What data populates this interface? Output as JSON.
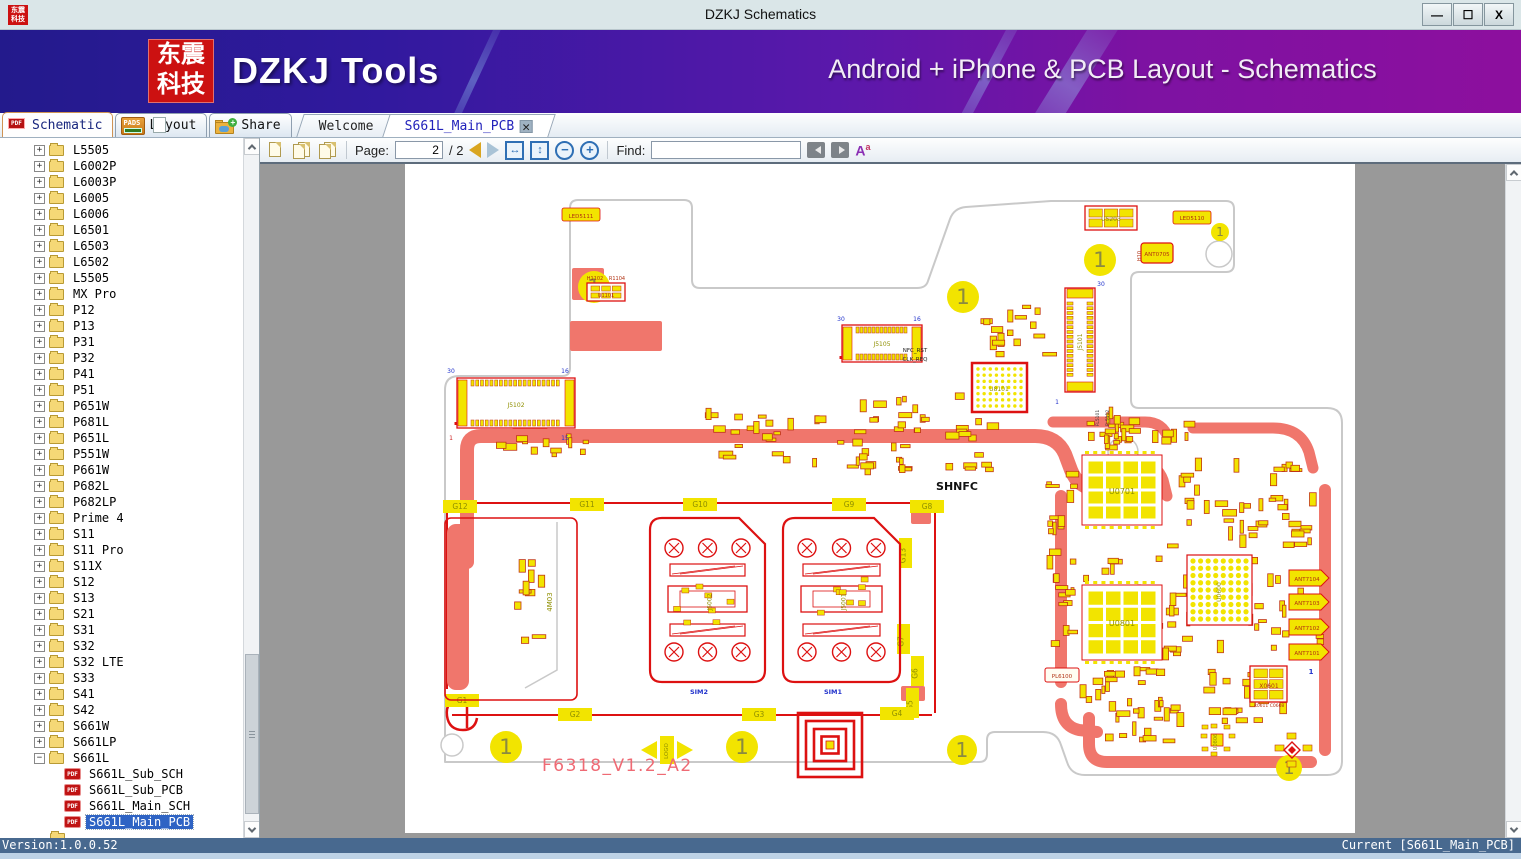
{
  "window": {
    "title": "DZKJ Schematics",
    "logo_text": "东震科技",
    "controls": [
      {
        "name": "minimize",
        "glyph": "—"
      },
      {
        "name": "maximize",
        "glyph": "☐"
      },
      {
        "name": "close",
        "glyph": "X"
      }
    ]
  },
  "banner": {
    "logo_line1": "东震",
    "logo_line2": "科技",
    "app_name": "DZKJ Tools",
    "tagline": "Android + iPhone & PCB Layout - Schematics"
  },
  "tabs": {
    "tool_tabs": [
      {
        "label": "Schematic",
        "icon": "pdf",
        "active": true
      },
      {
        "label": "Layout",
        "icon": "pads",
        "active": false
      },
      {
        "label": "Share",
        "icon": "share",
        "active": false
      }
    ],
    "doc_tabs": [
      {
        "label": "Welcome",
        "closable": false,
        "active": false
      },
      {
        "label": "S661L_Main_PCB",
        "closable": true,
        "active": true
      }
    ]
  },
  "toolbar": {
    "page_label": "Page:",
    "page_value": "2",
    "page_total": "/ 2",
    "find_label": "Find:",
    "find_value": ""
  },
  "sidebar": {
    "folders": [
      "L5505",
      "L6002P",
      "L6003P",
      "L6005",
      "L6006",
      "L6501",
      "L6503",
      "L6502",
      "L5505",
      "MX Pro",
      "P12",
      "P13",
      "P31",
      "P32",
      "P41",
      "P51",
      "P651W",
      "P681L",
      "P651L",
      "P551W",
      "P661W",
      "P682L",
      "P682LP",
      "Prime 4",
      "S11",
      "S11 Pro",
      "S11X",
      "S12",
      "S13",
      "S21",
      "S31",
      "S32",
      "S32 LTE",
      "S33",
      "S41",
      "S42",
      "S661W",
      "S661LP"
    ],
    "expanded_folder": "S661L",
    "documents": [
      {
        "label": "S661L_Sub_SCH",
        "selected": false
      },
      {
        "label": "S661L_Sub_PCB",
        "selected": false
      },
      {
        "label": "S661L_Main_SCH",
        "selected": false
      },
      {
        "label": "S661L_Main_PCB",
        "selected": true
      }
    ]
  },
  "statusbar": {
    "left": "Version:1.0.0.52",
    "right": "Current [S661L_Main_PCB]"
  },
  "pcb": {
    "colors": {
      "outline": "#c9c9c9",
      "copper": "#f0766c",
      "red": "#dd1111",
      "yellow": "#f2e400",
      "olive": "#8f8f00",
      "darkred": "#b03010",
      "blue": "#2233cc",
      "pink": "#ef6a74"
    },
    "outline_path": "M 40,598 V 226 Q 40,212 54,212 H 157 Q 165,212 165,204 V 44 Q 165,36 173,36 H 279 Q 287,36 287,44 V 116 Q 287,124 295,124 H 512 Q 521,124 523,117 L 545,55 Q 549,44 561,43 L 646,37 H 821 Q 829,37 829,45 V 100 Q 829,108 821,108 H 734 Q 726,108 726,116 V 236 Q 726,244 734,244 H 922 Q 937,244 937,259 V 597 Q 937,611 922,611 H 680 Q 666,611 662,598 L 656,581 Q 652,568 638,568 H 590 Q 582,568 582,576 V 590 Q 582,598 574,598 Z",
    "copper_strokes": [
      {
        "d": "M 62,398 V 286 Q 62,272 76,272 H 630 Q 652,272 660,290 L 666,306 Q 673,324 693,326 L 714,328",
        "w": 14
      },
      {
        "d": "M 734,298 Q 752,300 758,316 L 762,332",
        "w": 11
      },
      {
        "d": "M 648,258 H 740 Q 758,258 763,274",
        "w": 11
      },
      {
        "d": "M 788,264 H 868 Q 896,264 904,288 L 908,304",
        "w": 11
      },
      {
        "d": "M 920,326 V 586",
        "w": 12
      },
      {
        "d": "M 906,598 H 702 Q 684,598 684,580 V 554",
        "w": 12
      },
      {
        "d": "M 656,332 V 518",
        "w": 12
      },
      {
        "d": "M 656,540 Q 656,562 674,566 L 692,568",
        "w": 12
      }
    ],
    "copper_fills": [
      {
        "x": 165,
        "y": 157,
        "w": 92,
        "h": 30,
        "r": 2
      },
      {
        "x": 167,
        "y": 104,
        "w": 32,
        "h": 32,
        "r": 2
      },
      {
        "x": 107,
        "y": 262,
        "w": 36,
        "h": 10,
        "r": 5
      },
      {
        "x": 506,
        "y": 346,
        "w": 20,
        "h": 14,
        "r": 2
      },
      {
        "x": 496,
        "y": 522,
        "w": 24,
        "h": 15,
        "r": 2
      }
    ],
    "red_lines": [
      {
        "d": "M 42,339 H 530",
        "w": 2
      },
      {
        "d": "M 47,551 H 527",
        "w": 2
      },
      {
        "d": "M 530,341 V 549",
        "w": 2
      },
      {
        "d": "M 42,341 V 525",
        "w": 2
      },
      {
        "d": "M 56,534 q -16,2 -14,18 q 2,14 16,14 q 12,0 14,-12 M 62,534 v 30",
        "w": 2.5
      }
    ],
    "fiducials": [
      {
        "x": 189,
        "y": 123,
        "r": 16
      },
      {
        "x": 558,
        "y": 133,
        "r": 16
      },
      {
        "x": 695,
        "y": 96,
        "r": 16
      },
      {
        "x": 815,
        "y": 68,
        "r": 9
      },
      {
        "x": 101,
        "y": 583,
        "r": 16
      },
      {
        "x": 337,
        "y": 583,
        "r": 16
      },
      {
        "x": 557,
        "y": 586,
        "r": 15
      },
      {
        "x": 884,
        "y": 604,
        "r": 13
      }
    ],
    "holes": [
      {
        "x": 814,
        "y": 90,
        "r": 13
      },
      {
        "x": 718,
        "y": 288,
        "r": 15
      },
      {
        "x": 47,
        "y": 581,
        "r": 11
      }
    ],
    "g_pads": [
      {
        "label": "G12",
        "x": 38,
        "y": 336,
        "v": false
      },
      {
        "label": "G11",
        "x": 165,
        "y": 334,
        "v": false
      },
      {
        "label": "G10",
        "x": 278,
        "y": 334,
        "v": false
      },
      {
        "label": "G9",
        "x": 427,
        "y": 334,
        "v": false
      },
      {
        "label": "G8",
        "x": 505,
        "y": 336,
        "v": false
      },
      {
        "label": "G13",
        "x": 494,
        "y": 374,
        "v": true
      },
      {
        "label": "G7",
        "x": 492,
        "y": 460,
        "v": true
      },
      {
        "label": "G6",
        "x": 506,
        "y": 492,
        "v": true
      },
      {
        "label": "G5",
        "x": 501,
        "y": 524,
        "v": true
      },
      {
        "label": "G4",
        "x": 475,
        "y": 543,
        "v": false
      },
      {
        "label": "G3",
        "x": 337,
        "y": 544,
        "v": false
      },
      {
        "label": "G2",
        "x": 153,
        "y": 544,
        "v": false
      },
      {
        "label": "G1",
        "x": 40,
        "y": 530,
        "v": false
      }
    ],
    "connectors": [
      {
        "ref": "J5102",
        "x": 52,
        "y": 214,
        "w": 118,
        "h": 50,
        "vert": false,
        "pins": 19
      },
      {
        "ref": "J5105",
        "x": 437,
        "y": 161,
        "w": 80,
        "h": 37,
        "vert": false,
        "pins": 13
      },
      {
        "ref": "J5101",
        "x": 660,
        "y": 124,
        "w": 30,
        "h": 104,
        "vert": true,
        "pins": 16
      }
    ],
    "ics": [
      {
        "ref": "U8101",
        "type": "dots",
        "x": 567,
        "y": 199,
        "w": 55,
        "h": 49,
        "nx": 8,
        "ny": 7,
        "r": 1.7,
        "stroke": 2.5
      },
      {
        "ref": "U0600",
        "type": "dots",
        "x": 782,
        "y": 391,
        "w": 65,
        "h": 70,
        "nx": 8,
        "ny": 9,
        "r": 2.6,
        "stroke": 1.2
      },
      {
        "ref": "U0701",
        "type": "squares",
        "x": 677,
        "y": 291,
        "w": 80,
        "h": 70
      },
      {
        "ref": "U0801",
        "type": "squares",
        "x": 677,
        "y": 421,
        "w": 80,
        "h": 75
      },
      {
        "ref": "U5203",
        "type": "pads6",
        "x": 680,
        "y": 42,
        "w": 52,
        "h": 24,
        "cols": 3,
        "rows": 2
      },
      {
        "ref": "U1101",
        "type": "pads6",
        "x": 182,
        "y": 119,
        "w": 38,
        "h": 18,
        "cols": 3,
        "rows": 2
      },
      {
        "ref": "X0601",
        "type": "pads6",
        "x": 845,
        "y": 502,
        "w": 37,
        "h": 36,
        "cols": 2,
        "rows": 3
      },
      {
        "ref": "U0806",
        "type": "padring",
        "x": 797,
        "y": 561,
        "w": 30,
        "h": 30
      },
      {
        "ref": "X0802",
        "type": "diamond",
        "x": 872,
        "y": 571,
        "w": 30,
        "h": 30
      }
    ],
    "sim_slots": [
      {
        "x": 245,
        "y": 354,
        "w": 115,
        "h": 164,
        "label": "SIM2",
        "ref": "J5002"
      },
      {
        "x": 378,
        "y": 354,
        "w": 117,
        "h": 164,
        "label": "SIM1",
        "ref": "J5001"
      }
    ],
    "card_slot": {
      "x": 40,
      "y": 354,
      "w": 132,
      "h": 182,
      "ref": "4M03"
    },
    "ant_pads": [
      {
        "label": "ANT7104",
        "x": 884,
        "y": 406
      },
      {
        "label": "ANT7103",
        "x": 884,
        "y": 430
      },
      {
        "label": "ANT7102",
        "x": 884,
        "y": 455
      },
      {
        "label": "ANT7101",
        "x": 884,
        "y": 480
      }
    ],
    "spiral": {
      "cx": 425,
      "cy": 581,
      "sizes": [
        64,
        48,
        32,
        17
      ]
    },
    "logo_marker": {
      "x": 262,
      "y": 586,
      "label": "LOGO"
    },
    "clusters": [
      [
        405,
        228,
        125,
        85,
        34,
        1
      ],
      [
        298,
        238,
        92,
        62,
        18,
        2
      ],
      [
        88,
        268,
        115,
        26,
        12,
        3
      ],
      [
        540,
        222,
        58,
        88,
        16,
        4
      ],
      [
        575,
        140,
        80,
        58,
        16,
        5
      ],
      [
        688,
        236,
        50,
        52,
        12,
        6
      ],
      [
        640,
        296,
        34,
        195,
        22,
        7
      ],
      [
        762,
        292,
        158,
        92,
        44,
        8
      ],
      [
        762,
        392,
        158,
        100,
        44,
        9
      ],
      [
        660,
        388,
        115,
        108,
        34,
        10
      ],
      [
        662,
        502,
        112,
        58,
        22,
        11
      ],
      [
        782,
        502,
        100,
        58,
        22,
        12
      ],
      [
        682,
        254,
        115,
        32,
        16,
        13
      ],
      [
        108,
        388,
        34,
        92,
        10,
        14
      ],
      [
        700,
        540,
        80,
        40,
        14,
        15
      ]
    ],
    "labels": [
      {
        "t": "SHNFC",
        "x": 552,
        "y": 326,
        "s": 11,
        "c": "#111111",
        "b": true
      },
      {
        "t": "NFC_RST",
        "x": 510,
        "y": 188,
        "s": 5.5,
        "c": "#222222"
      },
      {
        "t": "CLK_REQ",
        "x": 510,
        "y": 197,
        "s": 5.5,
        "c": "#222222"
      },
      {
        "t": "SIM2",
        "x": 294,
        "y": 530,
        "s": 6.5,
        "c": "#2233cc",
        "b": true
      },
      {
        "t": "SIM1",
        "x": 428,
        "y": 530,
        "s": 6.5,
        "c": "#2233cc",
        "b": true
      },
      {
        "t": "30",
        "x": 46,
        "y": 209,
        "s": 6,
        "c": "#2233cc"
      },
      {
        "t": "16",
        "x": 160,
        "y": 209,
        "s": 6,
        "c": "#2233cc"
      },
      {
        "t": "15",
        "x": 160,
        "y": 276,
        "s": 6,
        "c": "#2233cc"
      },
      {
        "t": "1",
        "x": 46,
        "y": 276,
        "s": 6,
        "c": "#cc2222"
      },
      {
        "t": "30",
        "x": 436,
        "y": 157,
        "s": 6,
        "c": "#2233cc"
      },
      {
        "t": "16",
        "x": 512,
        "y": 157,
        "s": 6,
        "c": "#2233cc"
      },
      {
        "t": "1",
        "x": 652,
        "y": 240,
        "s": 6,
        "c": "#2233cc"
      },
      {
        "t": "30",
        "x": 696,
        "y": 122,
        "s": 6,
        "c": "#2233cc"
      },
      {
        "t": "1",
        "x": 906,
        "y": 510,
        "s": 7,
        "c": "#2233cc",
        "b": true
      },
      {
        "t": "H1102",
        "x": 190,
        "y": 116,
        "s": 5,
        "c": "#b03010"
      },
      {
        "t": "R1104",
        "x": 212,
        "y": 116,
        "s": 5,
        "c": "#b03010"
      },
      {
        "t": "LED5111",
        "x": 176,
        "y": 54,
        "s": 5.5,
        "c": "#b03010"
      },
      {
        "t": "LED5110",
        "x": 787,
        "y": 56,
        "s": 5.5,
        "c": "#b03010"
      },
      {
        "t": "ANT0705",
        "x": 752,
        "y": 92,
        "s": 5.5,
        "c": "#b03010"
      },
      {
        "t": "H10",
        "x": 736,
        "y": 92,
        "s": 5,
        "c": "#b03010",
        "r": -90
      },
      {
        "t": "U5203",
        "x": 706,
        "y": 57,
        "s": 6,
        "c": "#8f8f00"
      },
      {
        "t": "J5102",
        "x": 111,
        "y": 243,
        "s": 6,
        "c": "#8f8f00"
      },
      {
        "t": "J5105",
        "x": 477,
        "y": 182,
        "s": 6,
        "c": "#8f8f00"
      },
      {
        "t": "J5101",
        "x": 677,
        "y": 178,
        "s": 6,
        "c": "#8f8f00",
        "r": -90
      },
      {
        "t": "U8101",
        "x": 594,
        "y": 227,
        "s": 6,
        "c": "#8f8f00"
      },
      {
        "t": "FL5101",
        "x": 694,
        "y": 254,
        "s": 4.5,
        "c": "#333333",
        "r": -90
      },
      {
        "t": "FL5112",
        "x": 704,
        "y": 254,
        "s": 4.5,
        "c": "#333333",
        "r": -90
      },
      {
        "t": "U0701",
        "x": 717,
        "y": 330,
        "s": 8,
        "c": "#8f8f00"
      },
      {
        "t": "U0801",
        "x": 717,
        "y": 462,
        "s": 8,
        "c": "#8f8f00"
      },
      {
        "t": "U0600",
        "x": 816,
        "y": 428,
        "s": 6,
        "c": "#8f8f00",
        "r": -90
      },
      {
        "t": "X0601",
        "x": 864,
        "y": 524,
        "s": 6,
        "c": "#b03010"
      },
      {
        "t": "R0611 C0608",
        "x": 864,
        "y": 543,
        "s": 4.5,
        "c": "#b03010"
      },
      {
        "t": "PL6100",
        "x": 657,
        "y": 514,
        "s": 5.5,
        "c": "#b03010"
      },
      {
        "t": "U0806",
        "x": 812,
        "y": 578,
        "s": 5,
        "c": "#8f8f00",
        "r": -90
      },
      {
        "t": "U1101",
        "x": 201,
        "y": 133,
        "s": 5,
        "c": "#b03010"
      }
    ],
    "board_title": {
      "text": "F6318_V1.2_A2",
      "x": 137,
      "y": 607,
      "size": 17
    }
  }
}
